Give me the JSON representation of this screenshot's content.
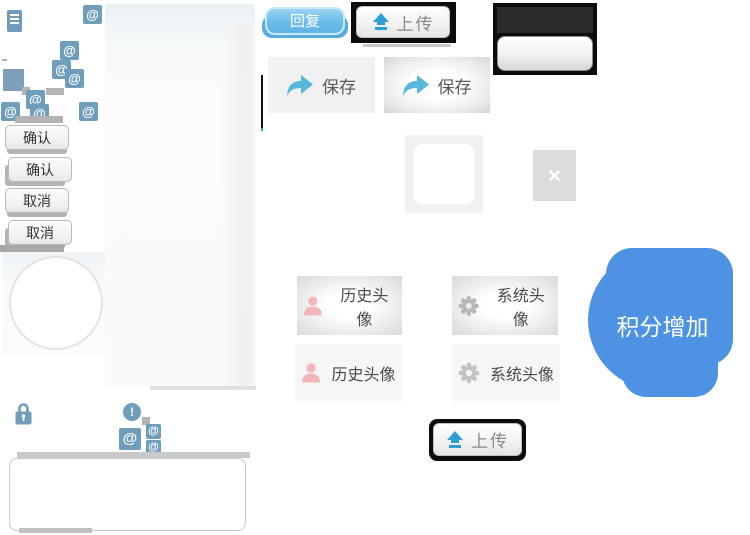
{
  "labels": {
    "reply": "回复",
    "upload": "上传",
    "save": "保存",
    "confirm": "确认",
    "cancel": "取消",
    "history_avatar": "历史头像",
    "system_avatar": "系统头像",
    "points_increase": "积分增加"
  },
  "glyphs": {
    "at": "@",
    "close": "×",
    "exclamation": "!"
  },
  "colors": {
    "icon_steel_blue": "#6f9dbc",
    "reply_blue": "#6cbcea",
    "upload_arrow_blue": "#2d9fd8",
    "save_arrow_blue": "#56b8dd",
    "points_blob_blue": "#4e93e3",
    "person_pink": "#f3b6ba",
    "gear_gray": "#b7b7b7",
    "button_border_black": "#0d0d0d"
  }
}
